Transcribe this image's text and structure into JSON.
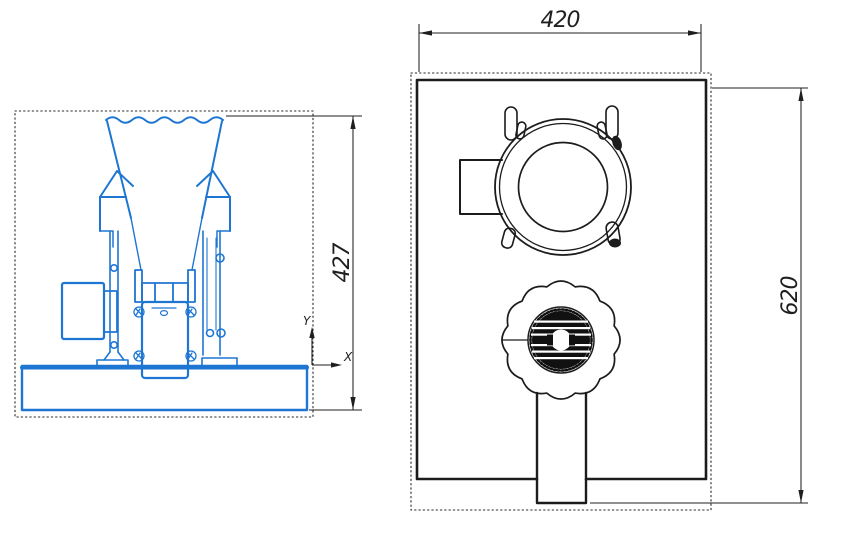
{
  "drawing": {
    "background": "#ffffff",
    "front_view": {
      "description": "front elevation of pellet machine",
      "line_color": "#1e76d2",
      "height_dim": "427",
      "axis_y": "Y",
      "axis_x": "X"
    },
    "top_view": {
      "description": "top plan view of pellet machine",
      "line_color": "#1c1c1c",
      "width_dim": "420",
      "depth_dim": "620"
    }
  }
}
